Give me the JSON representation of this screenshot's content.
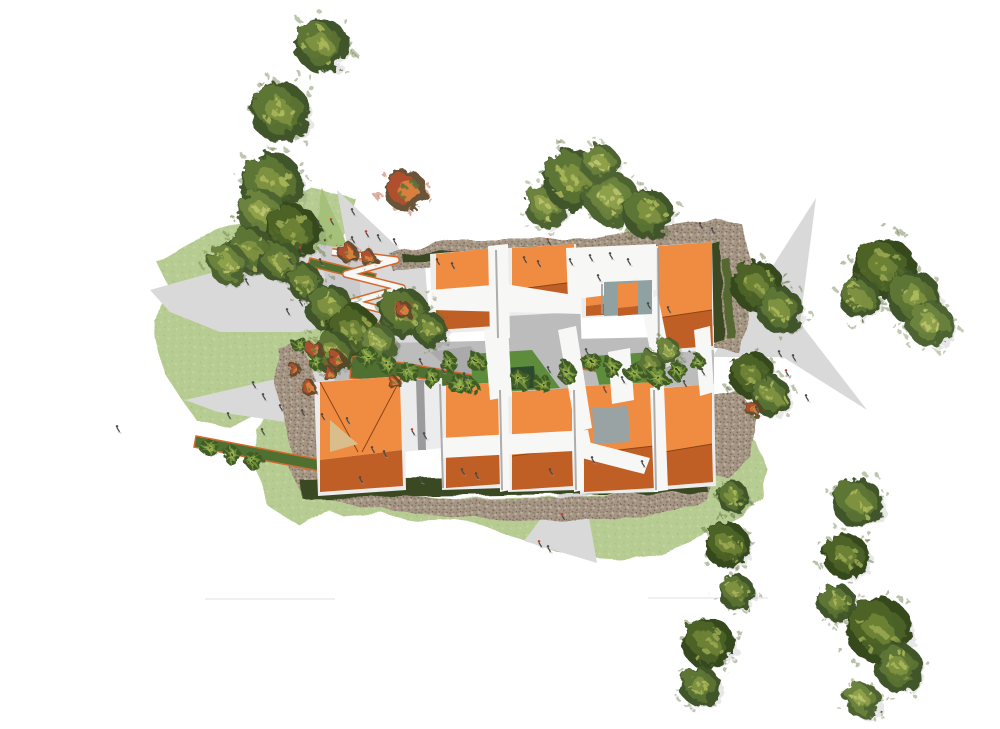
{
  "scene": {
    "kind": "architectural-site-plan-rendering",
    "width": 1000,
    "height": 729,
    "background": "#ffffff"
  },
  "palette": {
    "lawn": "#b7cc92",
    "lawn_dot1": "#a6bf82",
    "lawn_dot2": "#c8d8a4",
    "green_wedge": "#a5c179",
    "patch_green": "#5d8c3c",
    "patch_dark": "#2e4a2e",
    "planter": "#4f7030",
    "planter_edge": "#d4692e",
    "plaza": "#d9d9d9",
    "plaza_dark": "#cbcbcd",
    "court_paving": "#bcbcbc",
    "court_paving_dark": "#a5a5a5",
    "gravel": "#a59584",
    "gravel_dark": "#8c7d6d",
    "gravel_mid": "#7a6c5d",
    "gravel_light": "#bcaf9e",
    "hedge": "#3a4a24",
    "hedge_light": "#556830",
    "roof_light": "#f08c42",
    "roof_dark": "#bf5f26",
    "roof_deep": "#8c4517",
    "roof_pale": "#d9be8b",
    "wall": "#ececec",
    "wall_shadow": "#9b9b9d",
    "path_white": "#f7f7f6",
    "teal_court": "#8fa1a1",
    "gray_court": "#9aa3a3",
    "person": "#4a4a4a",
    "person_red": "#c43a2a",
    "faint_line": "#ececec",
    "tree_tones": {
      "dark": [
        "#35491f",
        "#4d6328",
        "#6d8136",
        "#9aa851"
      ],
      "mid": [
        "#41552a",
        "#5d7434",
        "#7e9140",
        "#abb95c"
      ],
      "light": [
        "#4e6330",
        "#6c833c",
        "#8fa04b",
        "#bcc46e"
      ]
    },
    "shrub_tones": [
      "#5d4526",
      "#b0502d",
      "#d97e3c",
      "#5d7338"
    ],
    "palm_tones": [
      "#3f5c26",
      "#6f8f3a",
      "#9ab050",
      "#2c401c"
    ]
  },
  "lawns": [
    "312,188 355,198 340,250 350,300 334,344 344,378 312,396 268,408 230,428 196,420 163,372 152,318 170,288 157,262 196,240 248,218 282,204",
    "268,408 312,396 332,428 340,468 332,506 300,526 268,506 254,462 256,430",
    "296,466 330,480 380,494 460,499 560,497 640,491 690,481 706,466 712,446 722,432 740,426 758,444 768,470 761,497 742,516 716,530 690,542 655,556 620,560 585,558 540,547 495,530 455,519 408,521 382,513 344,517 310,500"
  ],
  "green_wedges": [
    "322,188 358,268 310,272"
  ],
  "plazas": [
    "150,290 250,262 340,246 398,250 420,262 425,298 370,318 300,332 220,332 170,312",
    "185,400 280,378 368,362 440,360 470,362 520,380 556,396 540,420 470,436 380,438 285,422 218,412",
    "337,190 424,272 352,272",
    "318,244 420,262 430,330 340,348",
    "816,198 800,323 867,410 783,357 712,357 767,275",
    "567,484 583,484 597,563 524,541",
    "398,250 424,252 432,356 440,360 368,362 358,268"
  ],
  "gravel_areas": [
    "388,252 450,240 530,240 600,236 665,226 714,218 742,224 740,254 700,252 640,258 560,256 480,262 430,268 394,272",
    "714,218 742,224 752,268 748,318 738,352 714,348 720,300 714,254",
    "288,466 300,490 360,506 440,516 530,521 610,520 668,512 706,500 716,472 700,480 640,492 560,498 470,500 380,494 322,480 298,460",
    "278,348 302,340 322,400 334,462 320,482 298,470 284,420 274,380",
    "700,396 740,390 757,420 752,458 728,478 703,470 694,432"
  ],
  "hedges": [
    "300,480 706,474 708,492 302,498",
    "706,244 720,242 724,340 710,344",
    "402,254 540,248 541,257 403,263",
    "560,252 700,242 701,251 561,261"
  ],
  "hedge_light_strips": [
    "722,260 730,258 734,336 726,338"
  ],
  "court_paving_areas": [
    "340,344 712,336 714,400 600,404 500,402 342,402",
    "500,302 580,296 582,358 502,362",
    "332,356 442,352 442,396 336,398",
    "656,330 714,326 714,398 660,402"
  ],
  "court_streaks": [
    "430,352 470,346 520,392 480,398",
    "600,398 640,392 660,430 620,436"
  ],
  "planters": [
    "352,356 410,364 408,386 350,378",
    "410,364 500,380 497,392 408,376",
    "575,356 660,372 657,383 572,367",
    "196,436 332,462 330,473 194,447",
    "310,258 376,274 374,282 308,266"
  ],
  "green_patches": [
    {
      "pts": "470,354 532,350 560,388 474,394",
      "tone": "patch_green"
    },
    {
      "pts": "505,368 534,366 536,388 508,390",
      "tone": "patch_dark"
    },
    {
      "pts": "592,356 652,352 668,384 600,388",
      "tone": "patch_green"
    },
    {
      "pts": "436,380 470,388 468,396 434,388",
      "tone": "hedge_light"
    }
  ],
  "zigzag_path": "332,252 396,260 346,274 402,288 352,302 406,316 362,332",
  "buildings": [
    {
      "wall": "430,254 496,248 498,330 432,334",
      "light": "436,254 494,248 494,292 436,300",
      "dark": "436,300 494,292 495,326 436,330",
      "ridges": [
        "436,300 494,292"
      ]
    },
    {
      "wall": "506,248 576,244 578,312 508,316",
      "light": "512,248 574,244 574,282 512,290",
      "dark": "512,290 574,282 575,308 512,312",
      "ridges": [
        "512,290 574,282"
      ]
    },
    {
      "wall": "652,246 712,242 714,350 654,354",
      "light": "658,246 712,242 712,310 658,318",
      "dark": "658,318 712,310 713,346 658,350",
      "ridges": [
        "658,318 712,310"
      ]
    },
    {
      "wall": "580,280 622,278 624,316 582,318",
      "light": "586,280 620,278 620,302 586,306",
      "dark": "586,306 620,302 621,314 586,316",
      "ridges": []
    },
    {
      "wall": "314,382 404,376 406,490 318,496",
      "light": "320,382 402,376 402,450 320,460",
      "dark": "320,460 402,450 403,486 320,492",
      "ridges": [
        "320,382 358,452",
        "402,376 362,452"
      ],
      "extras": [
        {
          "pts": "330,420 358,444 330,452",
          "tone": "roof_pale"
        }
      ]
    },
    {
      "wall": "400,382 442,378 444,448 402,452",
      "extras": [
        {
          "pts": "416,380 424,380 426,450 418,450",
          "tone": "wall_shadow"
        }
      ]
    },
    {
      "wall": "440,386 502,382 504,488 442,490",
      "light": "446,386 500,382 500,446 446,454",
      "dark": "446,454 500,446 501,484 446,488",
      "ridges": [
        "446,454 500,446"
      ]
    },
    {
      "wall": "506,392 574,388 576,490 508,492",
      "light": "512,392 572,388 572,448 512,456",
      "dark": "512,456 572,448 573,486 512,490",
      "ridges": [
        "512,456 572,448"
      ]
    },
    {
      "wall": "578,386 656,382 658,492 580,494",
      "light": "584,386 654,382 654,446 584,454",
      "dark": "584,454 654,446 655,488 584,492",
      "ridges": [
        "584,454 654,446"
      ],
      "extras": [
        {
          "pts": "592,408 628,406 630,442 594,444",
          "tone": "gray_court"
        }
      ]
    },
    {
      "wall": "658,388 714,384 716,486 660,490",
      "light": "664,388 712,384 712,444 664,452",
      "dark": "664,452 712,444 713,482 664,486",
      "ridges": [
        "664,452 712,444"
      ]
    }
  ],
  "white_paths": [
    "488,246 508,244 510,338 490,340",
    "430,290 505,284 580,296 582,314 432,310",
    "566,248 656,244 656,290 600,296 568,300",
    "640,300 658,296 672,366 654,370",
    "484,330 508,326 512,396 490,400",
    "558,330 576,326 592,428 576,432",
    "608,352 630,348 634,400 612,404",
    "694,330 710,326 714,392 700,396",
    "440,438 588,430 592,450 442,458",
    "580,440 650,458 644,474 574,456",
    "650,388 664,386 668,490 654,492",
    "498,390 508,388 510,490 500,492",
    "572,388 582,384 584,490 574,492"
  ],
  "shadow_lines": [
    [
      496,
      250,
      498,
      338
    ],
    [
      440,
      384,
      443,
      488
    ],
    [
      500,
      390,
      502,
      490
    ],
    [
      574,
      390,
      576,
      490
    ],
    [
      654,
      390,
      656,
      490
    ],
    [
      602,
      284,
      602,
      314
    ],
    [
      658,
      248,
      659,
      352
    ]
  ],
  "teal_courts": [
    {
      "court": "604,282 652,280 652,314 604,316",
      "gable_light": "618,284 638,282 638,306 618,308",
      "gable_dark": "618,308 638,306 638,314 618,316"
    }
  ],
  "faint_lines": [
    [
      205,
      599,
      335,
      599
    ],
    [
      648,
      598,
      768,
      598
    ]
  ],
  "trees": [
    [
      321,
      45,
      27,
      "mid"
    ],
    [
      280,
      112,
      30,
      "mid"
    ],
    [
      271,
      184,
      32,
      "mid"
    ],
    [
      262,
      213,
      24,
      "light"
    ],
    [
      293,
      232,
      28,
      "dark"
    ],
    [
      251,
      251,
      24,
      "mid"
    ],
    [
      228,
      264,
      20,
      "light"
    ],
    [
      280,
      262,
      21,
      "mid"
    ],
    [
      305,
      282,
      18,
      "mid"
    ],
    [
      330,
      308,
      24,
      "mid"
    ],
    [
      353,
      331,
      26,
      "dark"
    ],
    [
      332,
      352,
      21,
      "mid"
    ],
    [
      404,
      313,
      25,
      "mid"
    ],
    [
      378,
      344,
      19,
      "light"
    ],
    [
      430,
      330,
      17,
      "mid"
    ],
    [
      545,
      206,
      21,
      "light"
    ],
    [
      574,
      180,
      31,
      "mid"
    ],
    [
      612,
      199,
      27,
      "light"
    ],
    [
      648,
      214,
      25,
      "mid"
    ],
    [
      600,
      163,
      19,
      "light"
    ],
    [
      757,
      286,
      26,
      "dark"
    ],
    [
      780,
      310,
      23,
      "mid"
    ],
    [
      752,
      375,
      23,
      "dark"
    ],
    [
      771,
      396,
      20,
      "mid"
    ],
    [
      884,
      268,
      31,
      "dark"
    ],
    [
      914,
      298,
      27,
      "mid"
    ],
    [
      930,
      324,
      23,
      "light"
    ],
    [
      860,
      298,
      21,
      "mid"
    ],
    [
      733,
      497,
      16,
      "mid"
    ],
    [
      727,
      545,
      23,
      "dark"
    ],
    [
      736,
      592,
      18,
      "mid"
    ],
    [
      708,
      643,
      26,
      "dark"
    ],
    [
      700,
      686,
      20,
      "mid"
    ],
    [
      858,
      503,
      25,
      "mid"
    ],
    [
      846,
      556,
      23,
      "dark"
    ],
    [
      837,
      603,
      19,
      "mid"
    ],
    [
      879,
      630,
      33,
      "dark"
    ],
    [
      899,
      668,
      24,
      "mid"
    ],
    [
      862,
      700,
      18,
      "light"
    ],
    [
      650,
      365,
      15,
      "mid"
    ],
    [
      668,
      351,
      13,
      "light"
    ]
  ],
  "shrubs": [
    [
      405,
      190,
      21
    ],
    [
      348,
      253,
      10
    ],
    [
      368,
      258,
      8
    ],
    [
      403,
      310,
      9
    ],
    [
      337,
      360,
      9
    ],
    [
      309,
      388,
      8
    ],
    [
      294,
      370,
      7
    ],
    [
      315,
      350,
      9
    ],
    [
      752,
      408,
      8
    ],
    [
      330,
      375,
      7
    ],
    [
      394,
      383,
      6
    ]
  ],
  "palms": [
    [
      368,
      357,
      10
    ],
    [
      388,
      365,
      9
    ],
    [
      408,
      372,
      10
    ],
    [
      432,
      378,
      9
    ],
    [
      458,
      384,
      10
    ],
    [
      476,
      362,
      9
    ],
    [
      520,
      380,
      10
    ],
    [
      543,
      384,
      9
    ],
    [
      566,
      372,
      10
    ],
    [
      592,
      362,
      9
    ],
    [
      612,
      368,
      10
    ],
    [
      634,
      373,
      9
    ],
    [
      658,
      378,
      10
    ],
    [
      678,
      371,
      9
    ],
    [
      697,
      362,
      8
    ],
    [
      210,
      448,
      9
    ],
    [
      232,
      455,
      9
    ],
    [
      254,
      461,
      9
    ],
    [
      300,
      345,
      8
    ],
    [
      316,
      362,
      8
    ],
    [
      448,
      362,
      9
    ],
    [
      470,
      386,
      8
    ]
  ],
  "people": [
    [
      318,
      224,
      0
    ],
    [
      331,
      222,
      1
    ],
    [
      352,
      212,
      0
    ],
    [
      300,
      250,
      1
    ],
    [
      290,
      262,
      0
    ],
    [
      320,
      262,
      0
    ],
    [
      352,
      240,
      0
    ],
    [
      366,
      234,
      1
    ],
    [
      378,
      238,
      0
    ],
    [
      394,
      242,
      0
    ],
    [
      258,
      270,
      0
    ],
    [
      246,
      282,
      0
    ],
    [
      300,
      303,
      0
    ],
    [
      287,
      312,
      0
    ],
    [
      253,
      385,
      0
    ],
    [
      263,
      397,
      0
    ],
    [
      280,
      408,
      0
    ],
    [
      302,
      413,
      0
    ],
    [
      322,
      417,
      0
    ],
    [
      347,
      421,
      0
    ],
    [
      262,
      432,
      0
    ],
    [
      117,
      429,
      0
    ],
    [
      228,
      416,
      0
    ],
    [
      437,
      262,
      0
    ],
    [
      452,
      266,
      0
    ],
    [
      524,
      260,
      0
    ],
    [
      538,
      264,
      0
    ],
    [
      570,
      262,
      0
    ],
    [
      590,
      258,
      0
    ],
    [
      610,
      256,
      0
    ],
    [
      628,
      262,
      0
    ],
    [
      598,
      278,
      0
    ],
    [
      648,
      306,
      0
    ],
    [
      668,
      310,
      0
    ],
    [
      700,
      226,
      0
    ],
    [
      712,
      231,
      0
    ],
    [
      548,
      242,
      1
    ],
    [
      420,
      362,
      0
    ],
    [
      442,
      370,
      0
    ],
    [
      464,
      376,
      0
    ],
    [
      548,
      370,
      0
    ],
    [
      562,
      376,
      0
    ],
    [
      604,
      390,
      1
    ],
    [
      622,
      380,
      0
    ],
    [
      684,
      384,
      0
    ],
    [
      702,
      372,
      0
    ],
    [
      586,
      352,
      0
    ],
    [
      779,
      354,
      0
    ],
    [
      793,
      358,
      0
    ],
    [
      786,
      373,
      1
    ],
    [
      806,
      398,
      0
    ],
    [
      756,
      410,
      0
    ],
    [
      372,
      450,
      0
    ],
    [
      384,
      454,
      0
    ],
    [
      412,
      432,
      1
    ],
    [
      424,
      436,
      0
    ],
    [
      462,
      472,
      0
    ],
    [
      476,
      476,
      0
    ],
    [
      550,
      472,
      0
    ],
    [
      592,
      460,
      0
    ],
    [
      642,
      464,
      0
    ],
    [
      360,
      480,
      0
    ],
    [
      420,
      480,
      0
    ],
    [
      562,
      517,
      1
    ],
    [
      539,
      544,
      1
    ],
    [
      548,
      549,
      0
    ]
  ]
}
